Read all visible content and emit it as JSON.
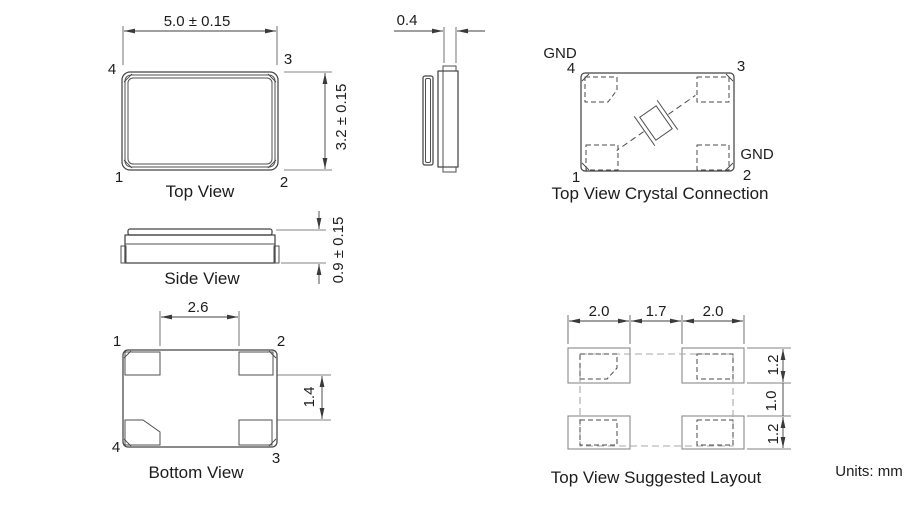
{
  "drawing": {
    "units_label": "Units: mm",
    "top_view": {
      "caption": "Top View",
      "dim_width": "5.0 ± 0.15",
      "dim_height": "3.2 ± 0.15",
      "pin1": "1",
      "pin2": "2",
      "pin3": "3",
      "pin4": "4"
    },
    "end_view": {
      "dim_width": "0.4"
    },
    "side_view": {
      "caption": "Side View",
      "dim_thickness": "0.9 ± 0.15"
    },
    "crystal_connection": {
      "caption": "Top View Crystal Connection",
      "gnd_top": "GND",
      "gnd_right": "GND",
      "pin1": "1",
      "pin2": "2",
      "pin3": "3",
      "pin4": "4"
    },
    "bottom_view": {
      "caption": "Bottom View",
      "dim_pad_inner_span": "2.6",
      "dim_pad_vertical_gap": "1.4",
      "pin1": "1",
      "pin2": "2",
      "pin3": "3",
      "pin4": "4"
    },
    "suggested_layout": {
      "caption": "Top View Suggested Layout",
      "dim_left_pad_width": "2.0",
      "dim_pad_gap": "1.7",
      "dim_right_pad_width": "2.0",
      "dim_top_pad_height": "1.2",
      "dim_row_gap": "1.0",
      "dim_bottom_pad_height": "1.2"
    },
    "colors": {
      "line": "#454545",
      "text": "#1c1c1c",
      "land_pad_line": "#8a8a8a",
      "outline_dash": "#a8a8a8",
      "background": "#ffffff"
    }
  }
}
